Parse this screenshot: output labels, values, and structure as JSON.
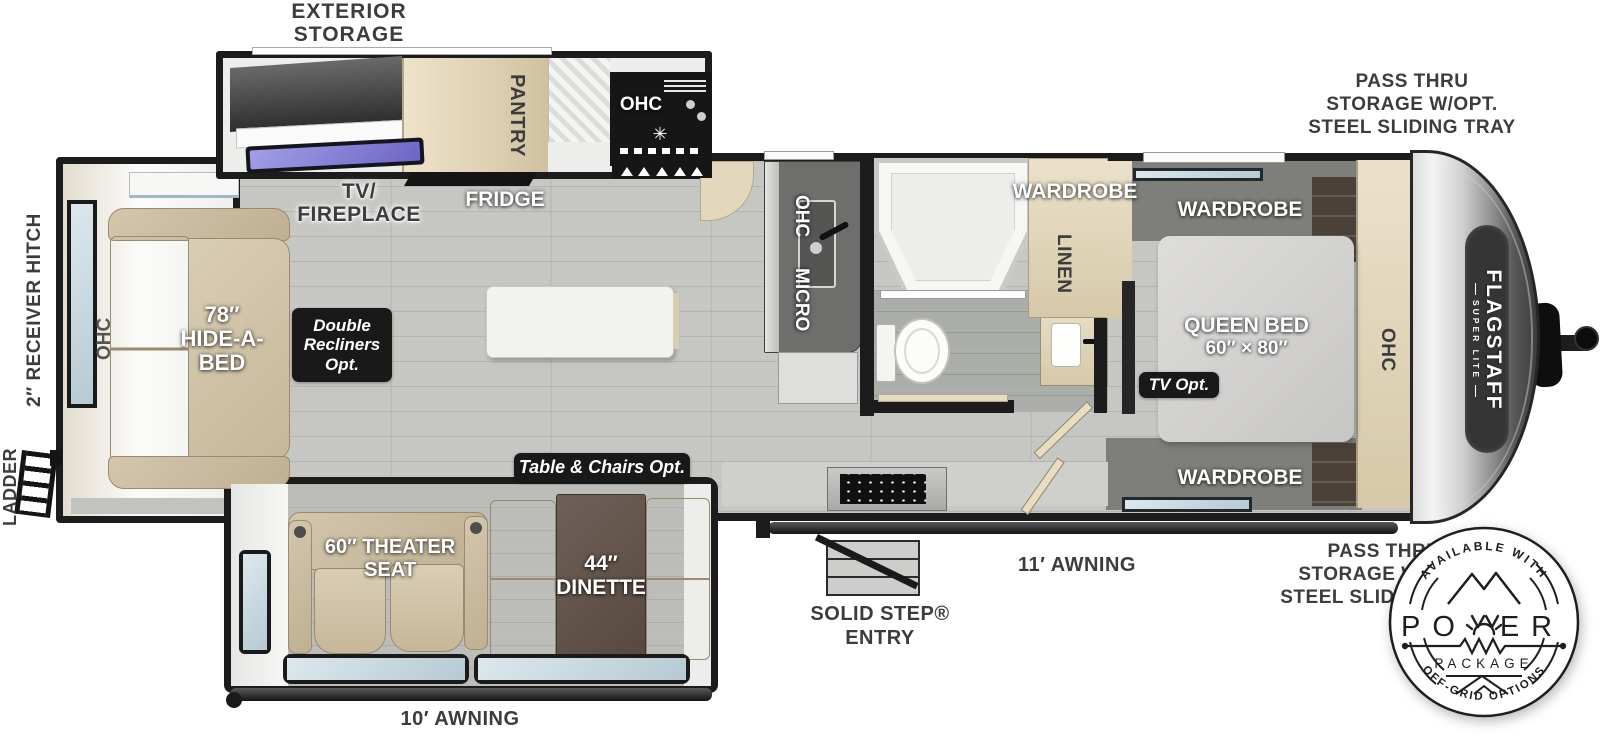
{
  "brand": {
    "name": "FLAGSTAFF",
    "sub": "SUPER LITE"
  },
  "colors": {
    "wall": "#1c1c1c",
    "floor": "#c6c7c3",
    "wood": "#e3d8be",
    "upholstery": "#cbbca1",
    "badge_bg": "#191919",
    "label_dark": "#3c3c3c",
    "tv_screen": "#8d87d8",
    "glass": "#c9dde7"
  },
  "exterior_labels": {
    "exterior_storage_line1": "EXTERIOR",
    "exterior_storage_line2": "STORAGE",
    "pass_thru_line1": "PASS THRU",
    "pass_thru_line2": "STORAGE W/OPT.",
    "pass_thru_line3": "STEEL SLIDING TRAY",
    "receiver_hitch": "2″ RECEIVER HITCH",
    "ladder": "LADDER",
    "awning_door_side": "11′ AWNING",
    "awning_off_door_side": "10′ AWNING",
    "solid_step_line1": "SOLID STEP®",
    "solid_step_line2": "ENTRY"
  },
  "interior_labels": {
    "tv_fireplace_line1": "TV/",
    "tv_fireplace_line2": "FIREPLACE",
    "fridge": "FRIDGE",
    "pantry": "PANTRY",
    "ohc": "OHC",
    "micro": "MICRO",
    "wardrobe": "WARDROBE",
    "linen": "LINEN",
    "queen_bed_line1": "QUEEN BED",
    "queen_bed_line2": "60″ × 80″",
    "hide_a_bed_line1": "78″",
    "hide_a_bed_line2": "HIDE-A-",
    "hide_a_bed_line3": "BED",
    "theater_seat_line1": "60″ THEATER",
    "theater_seat_line2": "SEAT",
    "dinette_line1": "44″",
    "dinette_line2": "DINETTE"
  },
  "option_badges": {
    "double_recliners_line1": "Double",
    "double_recliners_line2": "Recliners",
    "double_recliners_line3": "Opt.",
    "table_chairs": "Table & Chairs Opt.",
    "tv_opt": "TV Opt."
  },
  "power_badge": {
    "top_arc": "AVAILABLE WITH",
    "word_left": "PO",
    "word_right": "ER",
    "package": "PACKAGE",
    "bottom_arc": "OFF-GRID OPTIONS"
  },
  "icons": {
    "burner": "✳"
  }
}
